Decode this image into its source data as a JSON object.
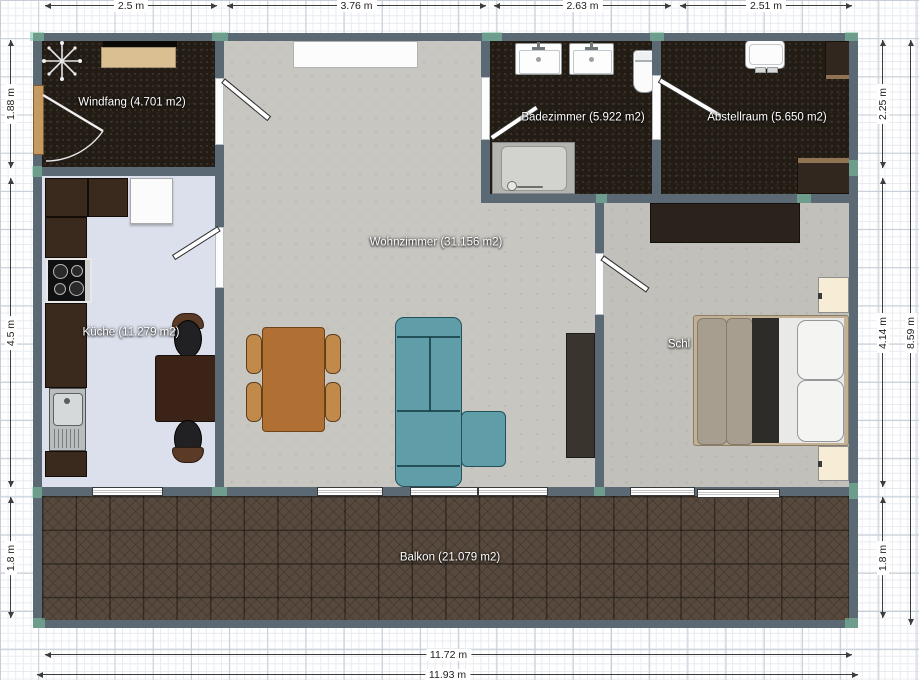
{
  "plan": {
    "rooms": {
      "windfang": "Windfang (4.701 m2)",
      "wohnzimmer": "Wohnzimmer (31.156 m2)",
      "kueche": "Küche (11.279 m2)",
      "badezimmer": "Badezimmer (5.922 m2)",
      "abstellraum": "Abstellraum (5.650 m2)",
      "schlafzimmer": "Schl",
      "balkon": "Balkon (21.079 m2)"
    },
    "dimensions": {
      "top": [
        "2.5 m",
        "3.76 m",
        "2.63 m",
        "2.51 m"
      ],
      "left": [
        "1.88 m",
        "4.5 m",
        "1.8 m"
      ],
      "right": [
        "2.25 m",
        "4.14 m",
        "1.8 m"
      ],
      "right_total": "8.59 m",
      "bottom_inner": "11.72 m",
      "bottom_outer": "11.93 m"
    },
    "colors": {
      "wall": "#5b6974",
      "dark_floor": "#231c15",
      "living_floor": "#c8c6c1",
      "bedroom_floor": "#c2c0bb",
      "kitchen_floor": "#dbe0ec",
      "balcony_floor": "#57493d",
      "corner_marker": "#7ec8a4",
      "sofa": "#5f9da9",
      "dining_table": "#b06f33",
      "kitchen_counter": "#3a2a1d",
      "bed_blanket": "#a89e90",
      "nightstand": "#f7ecd6",
      "entry_door": "#c49a62"
    }
  }
}
